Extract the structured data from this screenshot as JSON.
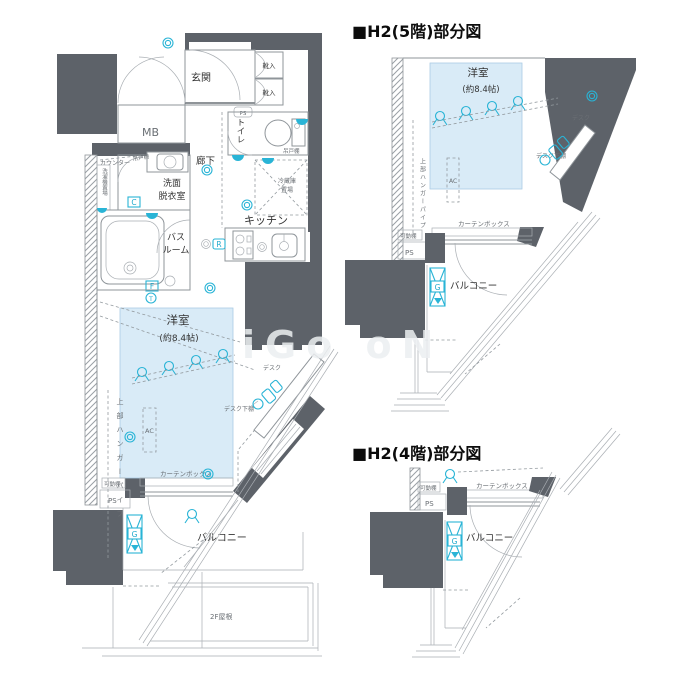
{
  "document": {
    "type": "floor-plan",
    "units_shown": [
      "H2"
    ]
  },
  "colors": {
    "wall": "#5d6269",
    "accent_cyan": "#29b4d6",
    "room_highlight": "#d9ebf7",
    "line": "#8f959a"
  },
  "icons": {
    "downlight-icon": "double circle ◎",
    "ceiling-light-icon": "circle with splayed legs",
    "wall-light-icon": "filled semicircle on wall",
    "chair-icon": "stool + seat blocks",
    "g-marker": "boxed X with letter"
  },
  "main_plan": {
    "rooms": {
      "genkan": "玄関",
      "shoes": "靴入",
      "mb": "MB",
      "hallway": "廊下",
      "toilet": "トイレ",
      "washroom_l1": "洗面",
      "washroom_l2": "脱衣室",
      "bath_l1": "バス",
      "bath_l2": "ルーム",
      "kitchen": "キッチン",
      "fridge_l1": "冷蔵庫",
      "fridge_l2": "置場",
      "western_room": "洋室",
      "western_size": "(約8.4帖)",
      "balcony": "バルコニー",
      "roof": "2F屋根"
    },
    "fixtures": {
      "counter": "カウンター",
      "hanging_cupboard": "吊戸棚",
      "toilet_shelf": "吊戸棚",
      "washer": "洗濯機置場",
      "ac": "AC",
      "desk": "デスク",
      "desk_shelf": "デスク下棚",
      "hanger_pipe": "上部ハンガーパイプ",
      "curtain_box": "カーテンボックス",
      "movable_shelf": "可動棚",
      "ps": "PS",
      "ps_small": "PS"
    },
    "markers": {
      "c": "C",
      "f": "F",
      "t": "T",
      "r": "R",
      "g": "G"
    }
  },
  "section_5f": {
    "title": "■H2(5階)部分図",
    "room": "洋室",
    "size": "(約8.4帖)",
    "desk": "デスク",
    "desk_shelf": "デスク下棚",
    "ac": "AC",
    "hanger_pipe": "上部ハンガーパイプ",
    "curtain_box": "カーテンボックス",
    "movable_shelf": "可動棚",
    "ps": "PS",
    "balcony": "バルコニー",
    "marker_g": "G"
  },
  "section_4f": {
    "title": "■H2(4階)部分図",
    "curtain_box": "カーテンボックス",
    "movable_shelf": "可動棚",
    "ps": "PS",
    "balcony": "バルコニー",
    "marker_g": "G"
  },
  "watermark": "iGo oN"
}
